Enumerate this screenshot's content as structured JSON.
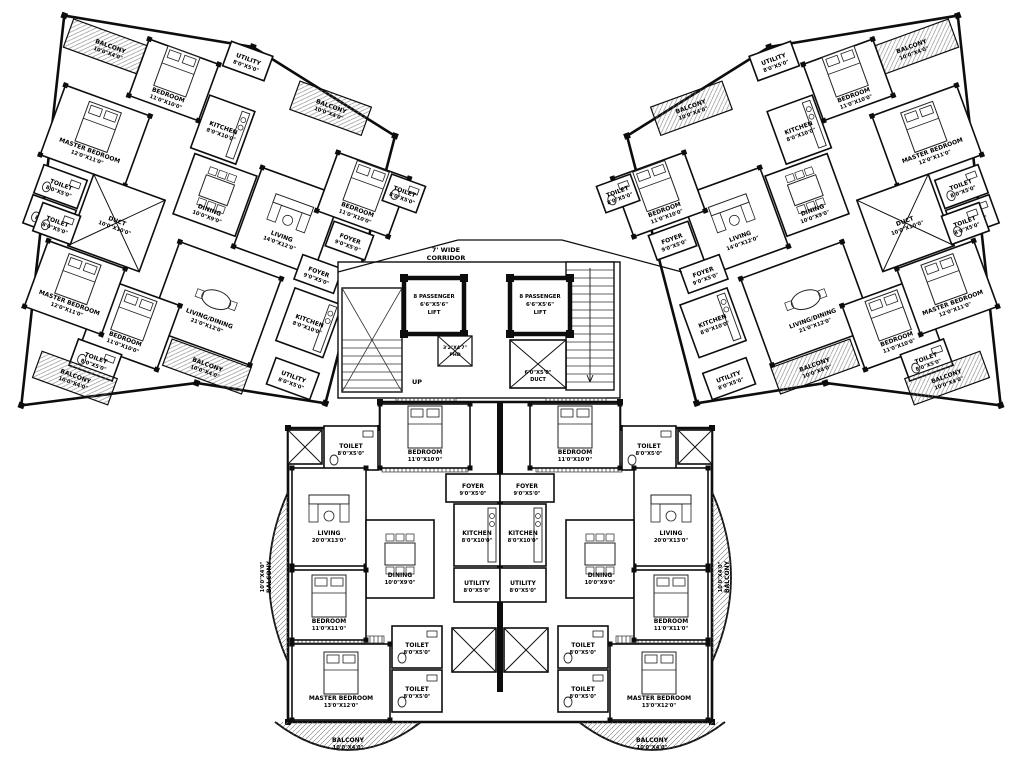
{
  "plan": {
    "bg": "#ffffff",
    "wall_color": "#0d0d0d",
    "corridor": {
      "line1": "7' WIDE",
      "line2": "CORRIDOR"
    },
    "up_label": "UP",
    "core": {
      "lifts": [
        {
          "x": 404,
          "y": 278,
          "w": 60,
          "h": 56,
          "lines": [
            "8 PASSENGER",
            "6'6\"X5'6\"",
            "LIFT"
          ]
        },
        {
          "x": 510,
          "y": 278,
          "w": 60,
          "h": 56,
          "lines": [
            "8 PASSENGER",
            "6'6\"X5'6\"",
            "LIFT"
          ]
        }
      ],
      "duct": {
        "x": 510,
        "y": 340,
        "w": 56,
        "h": 48,
        "lines": [
          "6'0\"X5'0\"",
          "DUCT"
        ]
      },
      "phd": {
        "x": 438,
        "y": 336,
        "w": 34,
        "h": 30,
        "lines": [
          "3'2\"X4'7\"",
          "PHD"
        ]
      }
    },
    "wing_rooms": [
      {
        "n": "BALCONY",
        "d": "10'0\"X4'0\"",
        "x": -390,
        "y": -205,
        "w": 88,
        "h": 30
      },
      {
        "n": "MASTER BEDROOM",
        "d": "12'0\"X11'0\"",
        "x": -375,
        "y": -140,
        "w": 90,
        "h": 74,
        "f": "bed"
      },
      {
        "n": "BEDROOM",
        "d": "11'0\"X10'0\"",
        "x": -312,
        "y": -212,
        "w": 74,
        "h": 60,
        "f": "bed"
      },
      {
        "n": "UTILITY",
        "d": "8'0\"X5'0\"",
        "x": -234,
        "y": -238,
        "w": 44,
        "h": 26
      },
      {
        "n": "KITCHEN",
        "d": "8'0\"X10'0\"",
        "x": -236,
        "y": -180,
        "w": 48,
        "h": 56,
        "f": "kitchen"
      },
      {
        "n": "TOILET",
        "d": "8'0\"X5'0\"",
        "x": -368,
        "y": -58,
        "w": 46,
        "h": 30,
        "f": "wc"
      },
      {
        "n": "TOILET",
        "d": "8'0\"X5'0\"",
        "x": -368,
        "y": -26,
        "w": 46,
        "h": 30,
        "f": "wc"
      },
      {
        "n": "DUCT",
        "d": "10'0\"X10'0\"",
        "x": -318,
        "y": -66,
        "w": 76,
        "h": 76,
        "f": "x"
      },
      {
        "n": "DINING",
        "d": "10'0\"X9'0\"",
        "x": -230,
        "y": -120,
        "w": 66,
        "h": 64,
        "f": "table"
      },
      {
        "n": "LIVING",
        "d": "14'0\"X12'0\"",
        "x": -162,
        "y": -130,
        "w": 84,
        "h": 84,
        "f": "sofa"
      },
      {
        "n": "FOYER",
        "d": "9'0\"X5'0\"",
        "x": -76,
        "y": -104,
        "w": 42,
        "h": 26
      },
      {
        "n": "BEDROOM",
        "d": "11'0\"X10'0\"",
        "x": -96,
        "y": -170,
        "w": 76,
        "h": 62,
        "f": "bed"
      },
      {
        "n": "BALCONY",
        "d": "10'0\"X4'0\"",
        "x": -156,
        "y": -224,
        "w": 76,
        "h": 30
      },
      {
        "n": "TOILET",
        "d": "8'0\"X5'0\"",
        "x": -38,
        "y": -168,
        "w": 36,
        "h": 28,
        "f": "wc"
      },
      {
        "n": "FOYER",
        "d": "9'0\"X5'0\"",
        "x": -94,
        "y": -62,
        "w": 42,
        "h": 26
      },
      {
        "n": "KITCHEN",
        "d": "8'0\"X10'0\"",
        "x": -90,
        "y": -28,
        "w": 50,
        "h": 56,
        "f": "kitchen"
      },
      {
        "n": "UTILITY",
        "d": "8'0\"X5'0\"",
        "x": -84,
        "y": 44,
        "w": 46,
        "h": 28
      },
      {
        "n": "LIVING/DINING",
        "d": "21'0\"X12'0\"",
        "x": -214,
        "y": -32,
        "w": 108,
        "h": 92,
        "f": "oval"
      },
      {
        "n": "BEDROOM",
        "d": "11'0\"X10'0\"",
        "x": -272,
        "y": 28,
        "w": 80,
        "h": 68,
        "f": "bed"
      },
      {
        "n": "MASTER BEDROOM",
        "d": "12'0\"X11'0\"",
        "x": -338,
        "y": 12,
        "w": 82,
        "h": 70,
        "f": "bed"
      },
      {
        "n": "TOILET",
        "d": "8'0\"X5'0\"",
        "x": -356,
        "y": -22,
        "w": 40,
        "h": 30,
        "f": "wc"
      },
      {
        "n": "TOILET",
        "d": "8'0\"X5'0\"",
        "x": -276,
        "y": 94,
        "w": 46,
        "h": 28,
        "f": "wc"
      },
      {
        "n": "BALCONY",
        "d": "10'0\"X4'0\"",
        "x": -306,
        "y": 118,
        "w": 80,
        "h": 28
      },
      {
        "n": "BALCONY",
        "d": "10'0\"X4'0\"",
        "x": -188,
        "y": 62,
        "w": 84,
        "h": 28
      }
    ],
    "bottom_rooms": [
      {
        "n": "",
        "d": "",
        "x": 288,
        "y": 430,
        "w": 34,
        "h": 34,
        "f": "x"
      },
      {
        "n": "TOILET",
        "d": "8'0\"X5'0\"",
        "x": 324,
        "y": 426,
        "w": 54,
        "h": 44,
        "f": "wc"
      },
      {
        "n": "BEDROOM",
        "d": "11'0\"X10'0\"",
        "x": 380,
        "y": 404,
        "w": 90,
        "h": 64,
        "f": "bed"
      },
      {
        "n": "FOYER",
        "d": "9'0\"X5'0\"",
        "x": 446,
        "y": 474,
        "w": 54,
        "h": 28
      },
      {
        "n": "KITCHEN",
        "d": "8'0\"X10'0\"",
        "x": 454,
        "y": 504,
        "w": 46,
        "h": 62,
        "f": "kitchen"
      },
      {
        "n": "UTILITY",
        "d": "8'0\"X5'0\"",
        "x": 454,
        "y": 568,
        "w": 46,
        "h": 34
      },
      {
        "n": "LIVING",
        "d": "20'0\"X13'0\"",
        "x": 292,
        "y": 468,
        "w": 74,
        "h": 98,
        "f": "sofa"
      },
      {
        "n": "DINING",
        "d": "10'0\"X9'0\"",
        "x": 366,
        "y": 520,
        "w": 68,
        "h": 78,
        "f": "table"
      },
      {
        "n": "BEDROOM",
        "d": "11'0\"X11'0\"",
        "x": 292,
        "y": 570,
        "w": 74,
        "h": 70,
        "f": "bed"
      },
      {
        "n": "MASTER BEDROOM",
        "d": "13'0\"X12'0\"",
        "x": 292,
        "y": 644,
        "w": 98,
        "h": 76,
        "f": "bed"
      },
      {
        "n": "TOILET",
        "d": "8'0\"X5'0\"",
        "x": 392,
        "y": 626,
        "w": 50,
        "h": 42,
        "f": "wc"
      },
      {
        "n": "TOILET",
        "d": "8'0\"X5'0\"",
        "x": 392,
        "y": 670,
        "w": 50,
        "h": 42,
        "f": "wc"
      },
      {
        "n": "",
        "d": "",
        "x": 452,
        "y": 628,
        "w": 44,
        "h": 44,
        "f": "x"
      },
      {
        "n": "BALCONY",
        "d": "10'0\"X4'0\"",
        "cx": 348,
        "cy": 742,
        "label_only": true
      },
      {
        "n": "BALCONY",
        "d": "10'0\"X4'0\"",
        "cx": 271,
        "cy": 577,
        "rot": -90,
        "label_only": true
      }
    ]
  }
}
